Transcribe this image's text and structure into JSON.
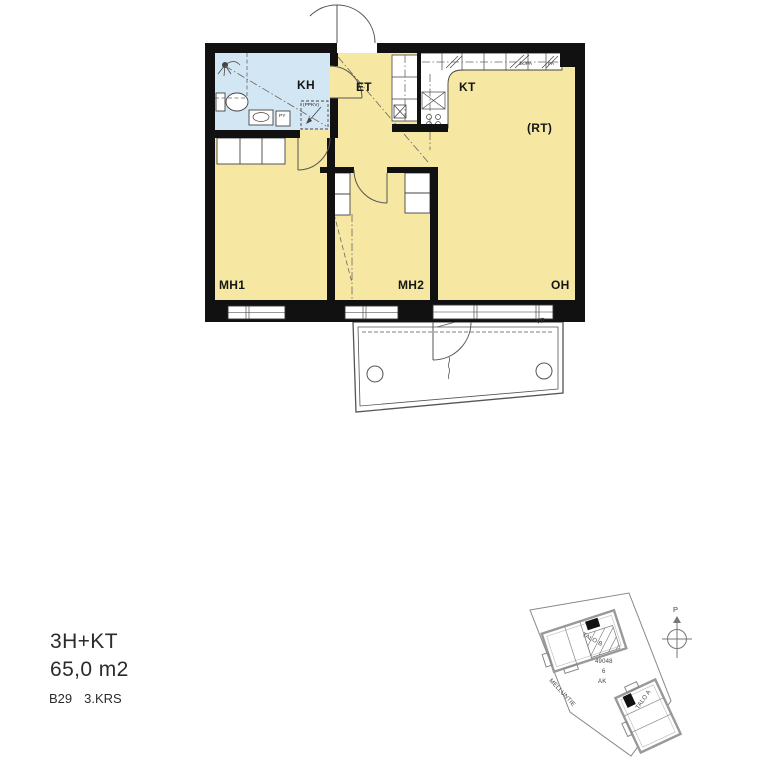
{
  "info": {
    "type_label": "3H+KT",
    "area_label": "65,0 m2",
    "unit_label": "B29",
    "floor_label": "3.KRS"
  },
  "floorplan": {
    "colors": {
      "wall": "#111111",
      "room_yellow": "#f6e7a2",
      "bath_blue": "#d3e6f4",
      "line": "#4a4a4a"
    },
    "rooms": [
      {
        "id": "kh",
        "label": "KH"
      },
      {
        "id": "et",
        "label": "ET"
      },
      {
        "id": "kt",
        "label": "KT"
      },
      {
        "id": "rt",
        "label": "(RT)"
      },
      {
        "id": "mh1",
        "label": "MH1"
      },
      {
        "id": "mh2",
        "label": "MH2"
      },
      {
        "id": "oh",
        "label": "OH"
      }
    ],
    "annotations": {
      "ppkv": "(PPKV)",
      "py": "PY",
      "jk_pa": "JK/PA",
      "pa": "PA",
      "vp": "VP"
    }
  },
  "siteplan": {
    "buildings": [
      {
        "label": "TALO B"
      },
      {
        "label": "TALO A"
      }
    ],
    "plot": {
      "number": "49048",
      "lot": "6",
      "zoning": "AK"
    },
    "street": "MELLUNTIE",
    "north_label": "P"
  }
}
